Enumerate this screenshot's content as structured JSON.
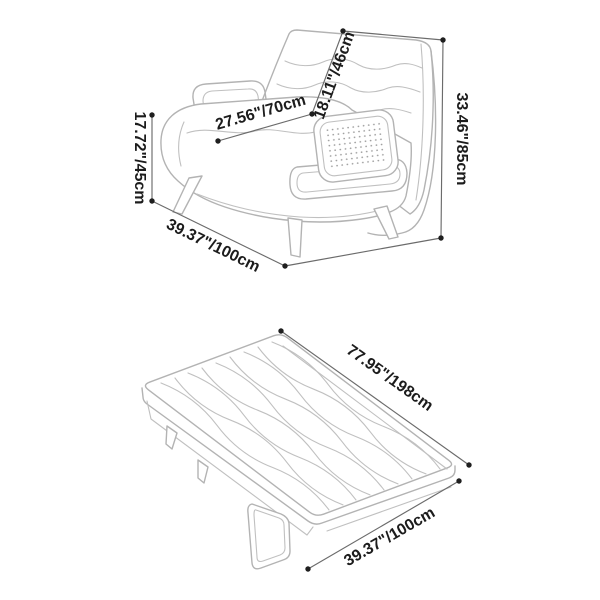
{
  "diagram": {
    "background": "#ffffff",
    "colors": {
      "furniture_line": "#b3b3b3",
      "dimension_line": "#6b6b6b",
      "label_text": "#1c1c1c",
      "endpoint_dot": "#1f1f1f",
      "cane_dots": "#9c9c9c"
    },
    "chair": {
      "seat_height": "17.72\"/45cm",
      "seat_depth": "27.56\"/70cm",
      "backrest_height": "18.11\"/46cm",
      "overall_height": "33.46\"/85cm",
      "overall_width": "39.37\"/100cm"
    },
    "bed": {
      "length": "77.95\"/198cm",
      "width": "39.37\"/100cm"
    }
  }
}
